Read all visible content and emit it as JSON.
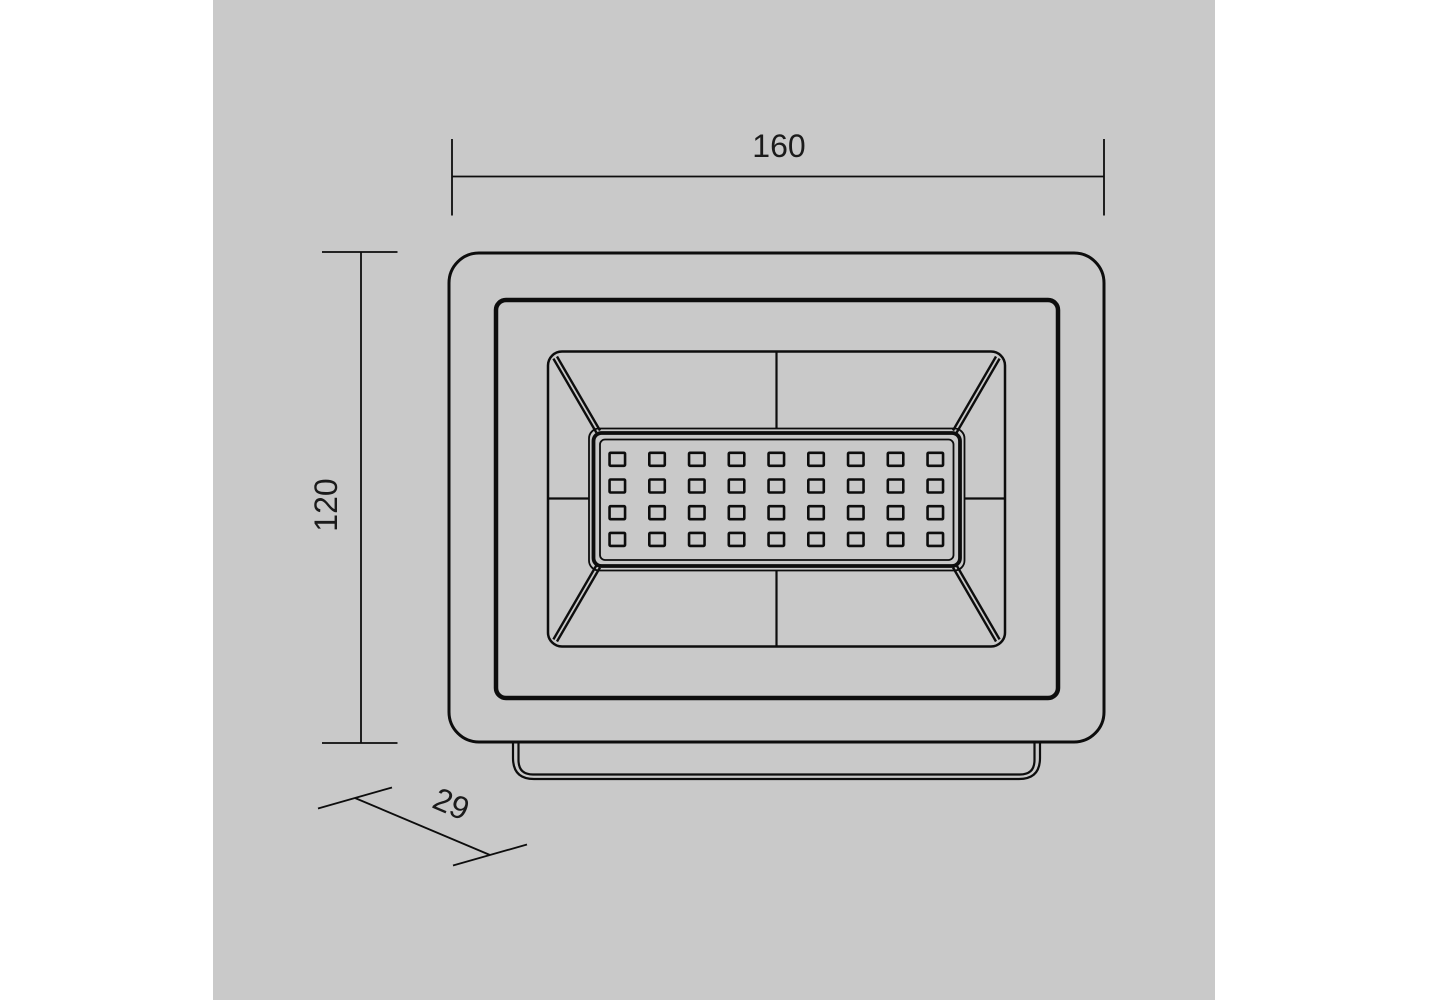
{
  "drawing": {
    "type": "technical-dimension-drawing",
    "subject": "LED floodlight front view",
    "paper_color": "#c9c9c9",
    "line_color": "#0d0d0d",
    "text_color": "#1b1b1b",
    "dimensions": {
      "width": {
        "value": "160"
      },
      "height": {
        "value": "120"
      },
      "depth": {
        "value": "29"
      }
    },
    "led_grid": {
      "columns": 9,
      "rows": 4
    }
  }
}
